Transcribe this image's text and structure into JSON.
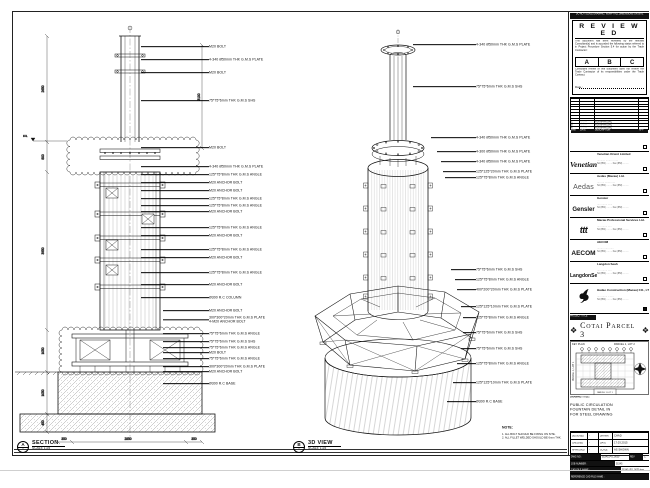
{
  "sheet": {
    "note_bar": "DO NOT SCALE DRAWING. VERIFY ALL DIMENSIONS ON SITE.",
    "stamp": {
      "title": "R E V I E W E D",
      "para1": "This document has been reviewed by the relevant Consultant(s) and is accorded the following status referred to in Project Procedure Section 5.4 for action by the Trade Contractor:",
      "options": [
        "A",
        "B",
        "C"
      ],
      "para2": "Consultant review of this document does not relieve the Trade Contractor of its responsibilities under the Trade Contract.",
      "date_label": "Date :"
    },
    "revisions": {
      "header": {
        "rev": "MRK",
        "date": "DATE",
        "desc": "DESCRIPTION",
        "by": "APP"
      },
      "rows": [
        {
          "rev": "",
          "date": "",
          "desc": "",
          "by": ""
        },
        {
          "rev": "",
          "date": "",
          "desc": "",
          "by": ""
        },
        {
          "rev": "",
          "date": "",
          "desc": "",
          "by": ""
        },
        {
          "rev": "",
          "date": "",
          "desc": "",
          "by": ""
        },
        {
          "rev": "",
          "date": "",
          "desc": "",
          "by": ""
        },
        {
          "rev": "",
          "date": "",
          "desc": "",
          "by": ""
        },
        {
          "rev": "",
          "date": "",
          "desc": "",
          "by": ""
        },
        {
          "rev": "",
          "date": "",
          "desc": "",
          "by": ""
        },
        {
          "rev": "C",
          "date": "··.··.····",
          "desc": "FOR APPROVAL",
          "by": "·"
        },
        {
          "rev": "B",
          "date": "··.··.····",
          "desc": "FOR APPROVAL",
          "by": "·"
        },
        {
          "rev": "A",
          "date": "··.··.····",
          "desc": "FOR APPROVAL",
          "by": "·"
        }
      ]
    },
    "consultants": [
      {
        "logo": "Venetian",
        "logo_class": "logo-venetian",
        "name": "Venetian Orient Limited",
        "lines": "··········· ········ ·· ·····\nTel (853) ········  Fax (853) ········"
      },
      {
        "logo": "Aedas",
        "logo_class": "logo-aedas",
        "name": "Aedas (Macau) Ltd.",
        "lines": "····· ···· ········ ·····\nTel (853) ········  Fax (853) ········"
      },
      {
        "logo": "Gensler",
        "logo_class": "logo-gensler",
        "name": "Gensler",
        "lines": "····· ········ ······\nTel (853) ········  Fax (853) ········"
      },
      {
        "logo": "ttt",
        "logo_class": "logo-ttt",
        "name": "Macau Professional Services Ltd.",
        "lines": "····· ········ ·····\nTel (853) ········  Fax (853) ········"
      },
      {
        "logo": "AECOM",
        "logo_class": "logo-aecom",
        "name": "AECOM",
        "lines": "········ ········ ·····\nTel (853) ········  Fax (853) ········"
      },
      {
        "logo": "LangdonSeah",
        "logo_class": "logo-langdonseah",
        "name": "Langdon Seah",
        "lines": "····· ········ ·····\nTel (853) ········  Fax (853) ········"
      }
    ],
    "contractor": {
      "name": "Hadao Construction (Macau) CO., LTD.",
      "lines": "····· ········ ·· ·····\nTel (853) ········  Fax (853) ········"
    },
    "project": {
      "label": "PROJECT TITLE",
      "title": "Cotai Parcel 3",
      "ornament_left": "❖",
      "ornament_right": "❖"
    },
    "key_plan": {
      "label": "KEY PLAN",
      "parcel_right": "PARCEL 1, LOT 2",
      "parcel_left": "PARCEL 1, LOT 1",
      "parcel_bottom": "PARCEL 1  LOT 1"
    },
    "title_block": {
      "drawing_title_label": "DRAWING TITLE:",
      "drawing_title": "PUBLIC CIRCULATION\nFOUNTAIN DETAIL IN\nFOR STEEL DRAWING",
      "fields": [
        {
          "l1": "DESIGNED",
          "v1": "-",
          "l2": "DRAWN",
          "v2": "CHAD"
        },
        {
          "l1": "CHECKED",
          "v1": "-",
          "l2": "DATE",
          "v2": "17.03.2015"
        },
        {
          "l1": "APPROVED",
          "v1": "-",
          "l2": "SCALE",
          "v2": "AS SHOWN"
        }
      ],
      "dwg_label": "DWG NO :",
      "dwg_no": "51545_PG_0030",
      "rev_label": "REV",
      "rev": "C",
      "job_label": "JOB NUMBER :",
      "job": "51545",
      "cad_label": "CAD FILE NAME :",
      "cad": "51545_PG_0030.dwg",
      "ref_label": "REFERENCE CAD FILE NAME :"
    },
    "note": {
      "title": "NOTE:",
      "lines": "1. ALL BOLT SHOULD BE FIXING ON SITE.\n2. ALL FILLET WELDED SHOULD BE 6mm THK."
    },
    "views": {
      "left": {
        "bubble": "A",
        "bubble_sub": "-",
        "title": "SECTION",
        "scale": "SCALE 1:25",
        "dims_left": [
          "2650",
          "800",
          "3950",
          "1050",
          "1050",
          "450"
        ],
        "dim_mid": "3100",
        "dims_bottom": [
          "350",
          "2850",
          "350"
        ],
        "level_label": "FFL",
        "annotations": [
          {
            "y": 35,
            "x": 128,
            "lw": 68,
            "t": "M20 BOLT"
          },
          {
            "y": 48,
            "x": 128,
            "lw": 68,
            "t": "4-340 Ø50mm THK G.M.S PLATE"
          },
          {
            "y": 61,
            "x": 128,
            "lw": 68,
            "t": "M20 BOLT"
          },
          {
            "y": 89,
            "x": 128,
            "lw": 68,
            "t": "75*75*6mm THK G.M.S SHS"
          },
          {
            "y": 136,
            "x": 128,
            "lw": 68,
            "t": "M20 BOLT"
          },
          {
            "y": 155,
            "x": 128,
            "lw": 68,
            "t": "4-340 Ø50mm THK G.M.S PLATE"
          },
          {
            "y": 163,
            "x": 128,
            "lw": 68,
            "t": "125*75*8mm THK G.M.S ANGLE"
          },
          {
            "y": 171,
            "x": 128,
            "lw": 68,
            "t": "M20 ANCHOR BOLT"
          },
          {
            "y": 179,
            "x": 128,
            "lw": 68,
            "t": "M20 ANCHOR BOLT"
          },
          {
            "y": 187,
            "x": 128,
            "lw": 68,
            "t": "125*75*8mm THK G.M.S ANGLE"
          },
          {
            "y": 194,
            "x": 128,
            "lw": 68,
            "t": "125*75*8mm THK G.M.S ANGLE"
          },
          {
            "y": 200,
            "x": 128,
            "lw": 68,
            "t": "M20 ANCHOR BOLT"
          },
          {
            "y": 216,
            "x": 128,
            "lw": 68,
            "t": "125*75*8mm THK G.M.S ANGLE"
          },
          {
            "y": 224,
            "x": 128,
            "lw": 68,
            "t": "M20 ANCHOR BOLT"
          },
          {
            "y": 238,
            "x": 128,
            "lw": 68,
            "t": "125*75*8mm THK G.M.S ANGLE"
          },
          {
            "y": 246,
            "x": 128,
            "lw": 68,
            "t": "M20 ANCHOR BOLT"
          },
          {
            "y": 261,
            "x": 128,
            "lw": 68,
            "t": "125*75*8mm THK G.M.S ANGLE"
          },
          {
            "y": 273,
            "x": 128,
            "lw": 68,
            "t": "M20 ANCHOR BOLT"
          },
          {
            "y": 286,
            "x": 128,
            "lw": 68,
            "t": "Ø300 R.C COLUMN"
          },
          {
            "y": 299,
            "x": 150,
            "lw": 46,
            "t": "M20 ANCHOR BOLT"
          },
          {
            "y": 308,
            "x": 150,
            "lw": 46,
            "t": "300*300*20mm THK G.M.S PLATE\n4-M20 ANCHOR BOLT"
          },
          {
            "y": 322,
            "x": 150,
            "lw": 46,
            "t": "75*75*6mm THK G.M.S ANGLE"
          },
          {
            "y": 330,
            "x": 150,
            "lw": 46,
            "t": "75*75*6mm THK G.M.S SHS"
          },
          {
            "y": 336,
            "x": 150,
            "lw": 46,
            "t": "75*75*6mm THK G.M.S ANGLE"
          },
          {
            "y": 341,
            "x": 150,
            "lw": 46,
            "t": "M20 BOLT"
          },
          {
            "y": 347,
            "x": 150,
            "lw": 46,
            "t": "75*75*6mm THK G.M.S ANGLE"
          },
          {
            "y": 355,
            "x": 150,
            "lw": 46,
            "t": "300*300*20mm THK G.M.S PLATE"
          },
          {
            "y": 360,
            "x": 150,
            "lw": 46,
            "t": "M20 ANCHOR BOLT"
          },
          {
            "y": 372,
            "x": 150,
            "lw": 46,
            "t": "Ø300 R.C BASE"
          }
        ]
      },
      "right": {
        "bubble": "B",
        "bubble_sub": "-",
        "title": "3D VIEW",
        "scale": "SCALE 1:25",
        "annotations": [
          {
            "y": 33,
            "x": 400,
            "lw": 63,
            "t": "4-340 Ø50mm THK G.M.S PLATE"
          },
          {
            "y": 75,
            "x": 400,
            "lw": 63,
            "t": "75*75*6mm THK G.M.S SHS"
          },
          {
            "y": 126,
            "x": 418,
            "lw": 45,
            "t": "4-340 Ø50mm THK G.M.S PLATE"
          },
          {
            "y": 140,
            "x": 424,
            "lw": 39,
            "t": "4-300 Ø50mm THK G.M.S PLATE"
          },
          {
            "y": 150,
            "x": 428,
            "lw": 35,
            "t": "4-340 Ø50mm THK G.M.S PLATE"
          },
          {
            "y": 160,
            "x": 430,
            "lw": 33,
            "t": "125*125*20mm THK G.M.S PLATE"
          },
          {
            "y": 166,
            "x": 432,
            "lw": 31,
            "t": "125*75*8mm THK G.M.S ANGLE"
          },
          {
            "y": 258,
            "x": 438,
            "lw": 25,
            "t": "75*75*6mm THK G.M.S SHS"
          },
          {
            "y": 268,
            "x": 442,
            "lw": 21,
            "t": "125*75*8mm THK G.M.S ANGLE"
          },
          {
            "y": 278,
            "x": 444,
            "lw": 19,
            "t": "400*200*20mm THK G.M.S PLATE"
          },
          {
            "y": 295,
            "x": 448,
            "lw": 15,
            "t": "125*125*10mm THK G.M.S PLATE"
          },
          {
            "y": 306,
            "x": 450,
            "lw": 13,
            "t": "125*75*8mm THK G.M.S ANGLE"
          },
          {
            "y": 321,
            "x": 450,
            "lw": 13,
            "t": "75*75*6mm THK G.M.S SHS"
          },
          {
            "y": 337,
            "x": 448,
            "lw": 15,
            "t": "75*75*6mm THK G.M.S SHS"
          },
          {
            "y": 352,
            "x": 444,
            "lw": 19,
            "t": "125*75*8mm THK G.M.S ANGLE"
          },
          {
            "y": 371,
            "x": 440,
            "lw": 23,
            "t": "125*125*10mm THK G.M.S PLATE"
          },
          {
            "y": 390,
            "x": 434,
            "lw": 29,
            "t": "Ø300 R.C BASE"
          }
        ]
      }
    }
  }
}
